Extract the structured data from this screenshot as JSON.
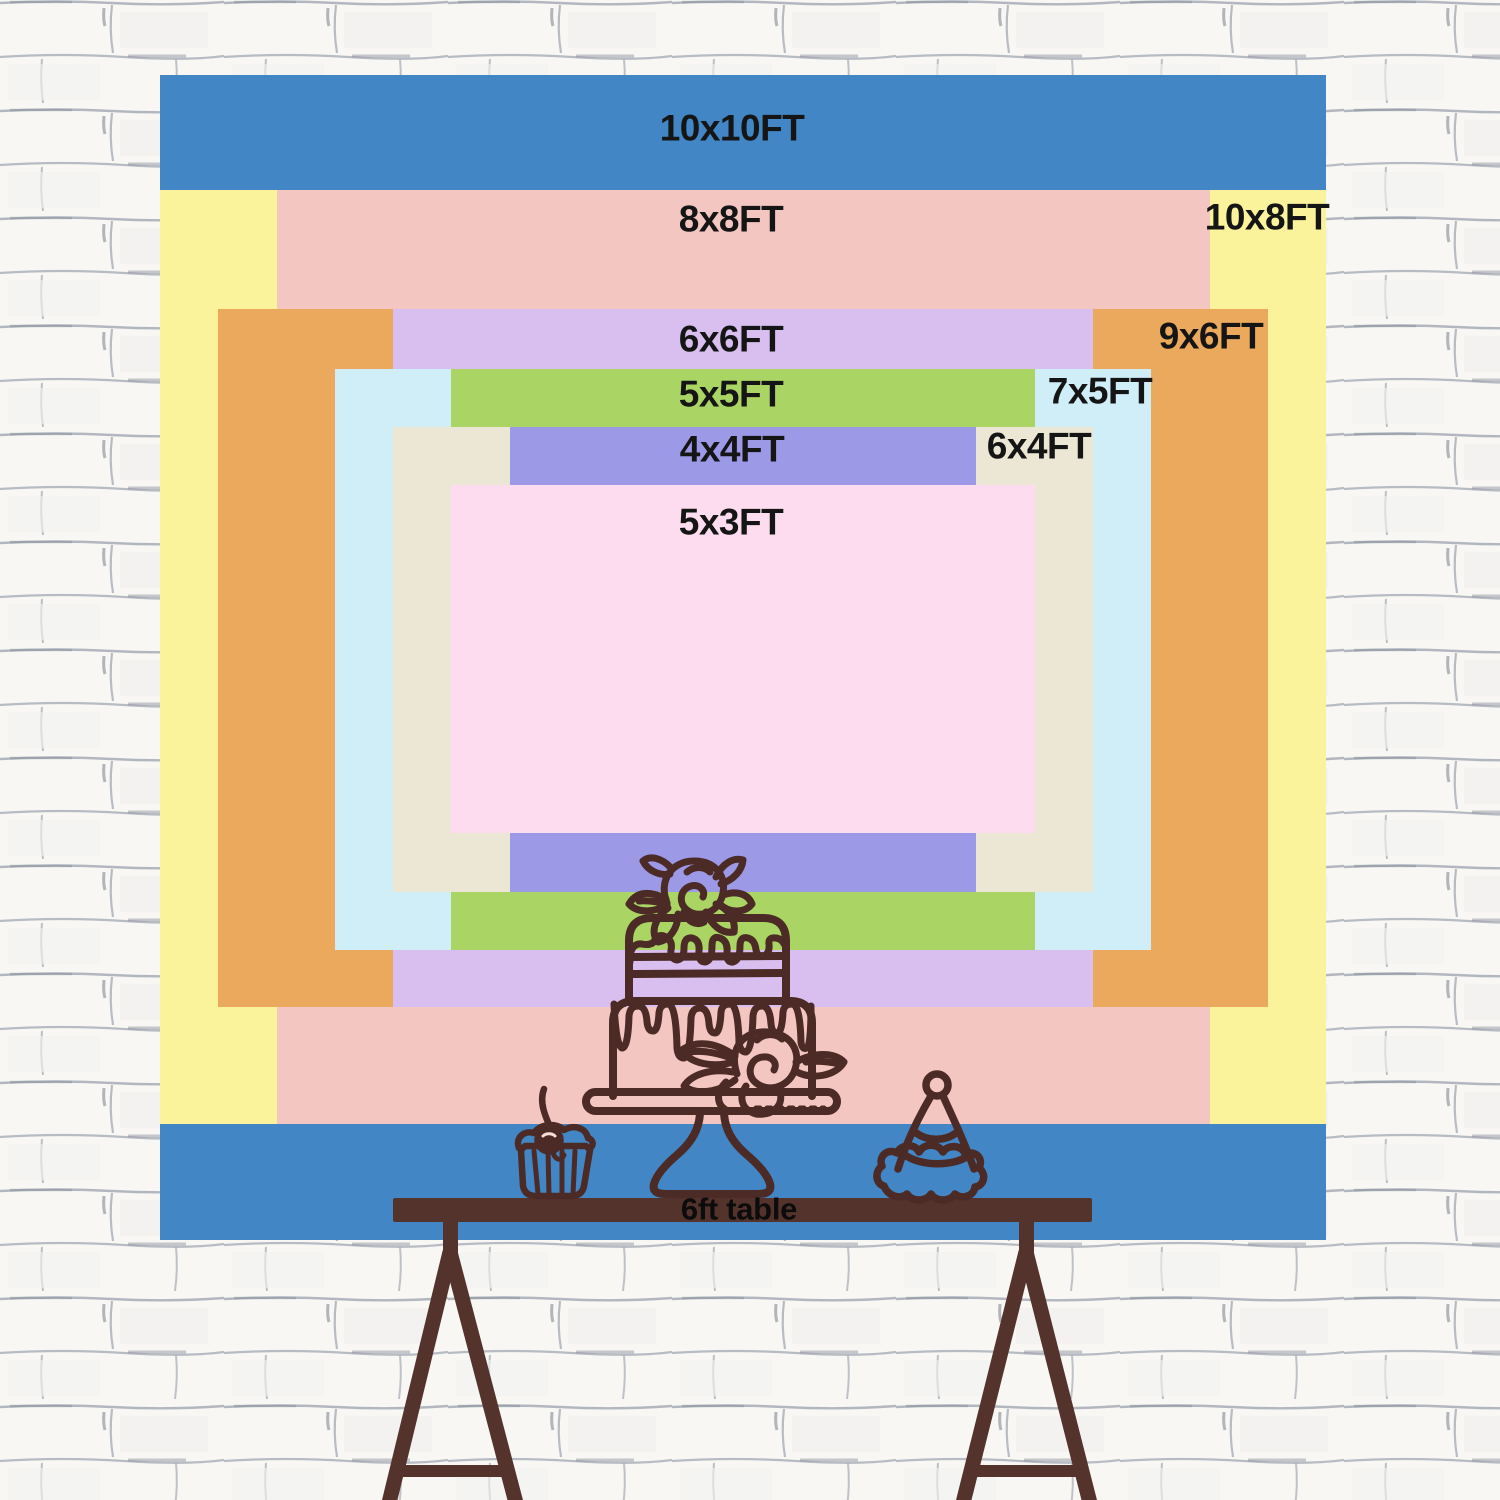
{
  "backdrop": {
    "sizes": [
      {
        "id": "10x10",
        "label": "10x10FT",
        "color": "#4286c5"
      },
      {
        "id": "10x8",
        "label": "10x8FT",
        "color": "#fbf39b"
      },
      {
        "id": "8x8",
        "label": "8x8FT",
        "color": "#f3c6c2"
      },
      {
        "id": "9x6",
        "label": "9x6FT",
        "color": "#eaa95c"
      },
      {
        "id": "6x6",
        "label": "6x6FT",
        "color": "#d9bef0"
      },
      {
        "id": "7x5",
        "label": "7x5FT",
        "color": "#d0eef8"
      },
      {
        "id": "5x5",
        "label": "5x5FT",
        "color": "#aad565"
      },
      {
        "id": "6x4",
        "label": "6x4FT",
        "color": "#ece7d5"
      },
      {
        "id": "4x4",
        "label": "4x4FT",
        "color": "#9c99e7"
      },
      {
        "id": "5x3",
        "label": "5x3FT",
        "color": "#fcdcee"
      }
    ]
  },
  "table": {
    "label": "6ft table",
    "color": "#54332d"
  },
  "illustration": {
    "stroke": "#4c2a26",
    "highlight": "#f6ddd8",
    "items": [
      "birthday-cake",
      "cupcake",
      "party-hat"
    ]
  },
  "wall": {
    "base": "#f8f7f4",
    "mortar": "#a6acb6",
    "accent": "#767d89"
  }
}
